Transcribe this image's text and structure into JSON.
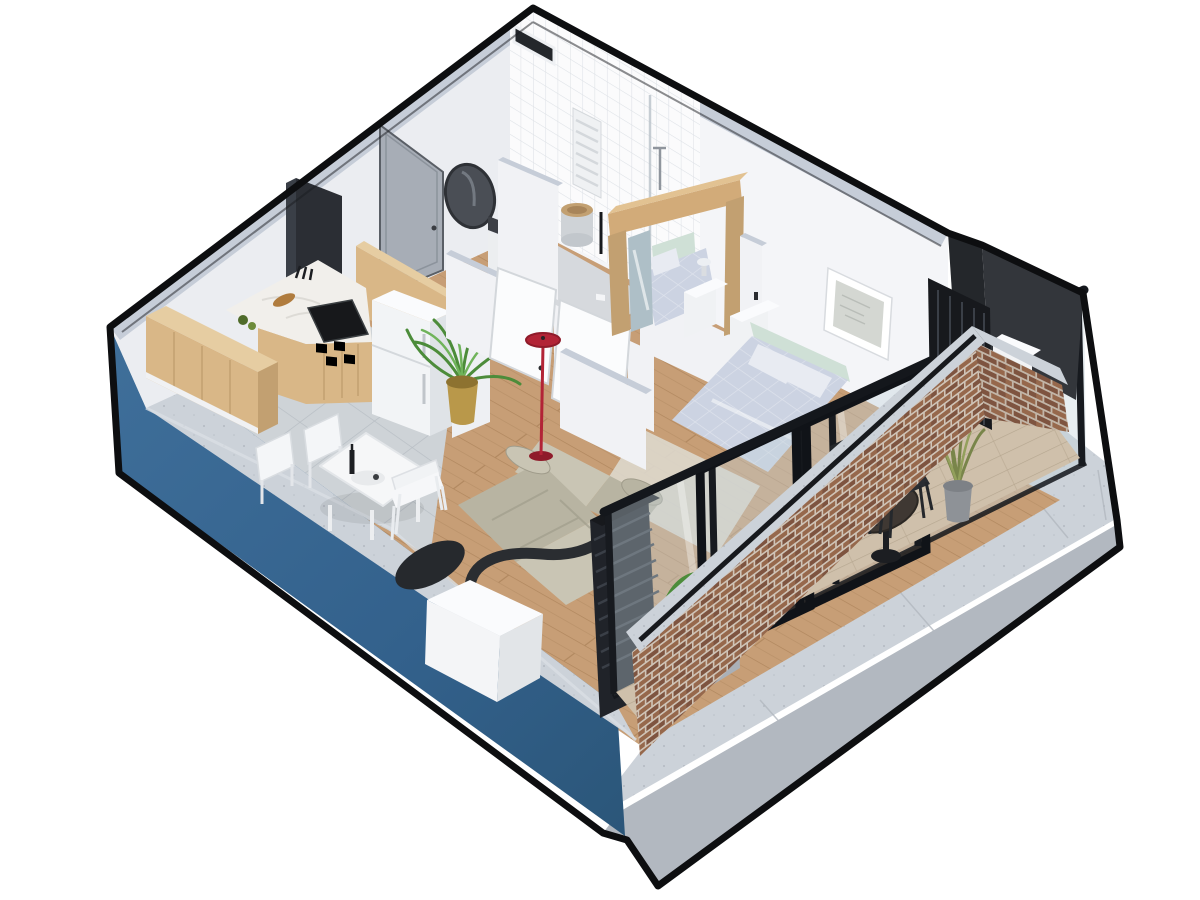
{
  "scene": {
    "type": "isometric-3d-floorplan-render",
    "rooms": [
      "kitchen",
      "dining-area",
      "living-room",
      "bathroom",
      "bed-nook",
      "master-bedroom",
      "balcony",
      "utility-niche"
    ],
    "objects": [
      "kitchen-counter",
      "range-hood",
      "gas-cooktop",
      "fridge",
      "pantry-panel",
      "dining-table",
      "dining-chairs",
      "wine-bottle",
      "palm-plant-gold-pot",
      "modular-sofa",
      "red-floor-lamp",
      "pellet-stove",
      "flue-pipe",
      "vent-column",
      "bathroom-mirror",
      "sink-vanity",
      "toilet",
      "towel-radiator",
      "bed-nook-wood-portal",
      "nook-mirror",
      "single-bed",
      "nightstands",
      "double-bed",
      "pillows",
      "headboard",
      "wall-poster",
      "pouf",
      "area-rug",
      "glass-partition",
      "sliding-doors",
      "brick-parapet",
      "concrete-cap",
      "handrail",
      "bistro-chairs",
      "round-table",
      "grass-plant",
      "planter-box",
      "louver-screens",
      "ac-outdoor-unit",
      "concrete-platform",
      "blue-facade",
      "entry-door",
      "vent-slot"
    ]
  },
  "palette": {
    "outline": "#0d0e10",
    "bg": "#ffffff",
    "blue_hi": "#3f6f9a",
    "blue": "#33618c",
    "blue_dk": "#2b5679",
    "concrete": "#ccd2d9",
    "concrete_dk": "#b2b8c0",
    "concrete_lt": "#d9dee4",
    "cap": "#c6cdd8",
    "wall_nw": "#ebedf1",
    "wall_ne": "#f4f5f8",
    "wall_in": "#f1f2f5",
    "wall_shade": "#dfe2e8",
    "tile_floor": "#ced3d7",
    "tile_line": "#b9bfc5",
    "bath_floor": "#d6d9dd",
    "wood_floor": "#c79e76",
    "wood_floor_ln": "#b0875e",
    "balcony_floor": "#cfc0ab",
    "balcony_ln": "#b5a68f",
    "wood_lt": "#e6cda2",
    "wood": "#d9b787",
    "wood_dk": "#c2a071",
    "marble": "#f1efeb",
    "marble_vein": "#d8d6d1",
    "black_steel": "#2b2e34",
    "black_deep": "#17191d",
    "slat": "#3a3f47",
    "fridge": "#f2f4f6",
    "fridge_side": "#dfe3e7",
    "white_hi": "#fafbfd",
    "door_grey": "#a7adb6",
    "glass": "#c3d3da",
    "frame": "#14171c",
    "sofa": "#b8b4a2",
    "sofa_lt": "#c9c5b4",
    "sofa_dk": "#a09c8b",
    "bed": "#ccd3e2",
    "bed_lt": "#e8ebf2",
    "headboard": "#cfe0d6",
    "rug": "#ddd8cd",
    "lamp_red": "#b22436",
    "lamp_red_dk": "#8f1b2a",
    "plant": "#4c8c3a",
    "plant_lt": "#6fb35a",
    "grass": "#79854a",
    "gold": "#b9984a",
    "gold_dk": "#8d7230",
    "brick": "#96684c",
    "brick_dk": "#7e5440",
    "mortar": "#cfc3b6",
    "niche_a": "#33363b",
    "niche_b": "#24272b",
    "dark_table": "#3f3833",
    "mirror": "#aebfc7",
    "mirror_dk": "#4a4e55"
  }
}
